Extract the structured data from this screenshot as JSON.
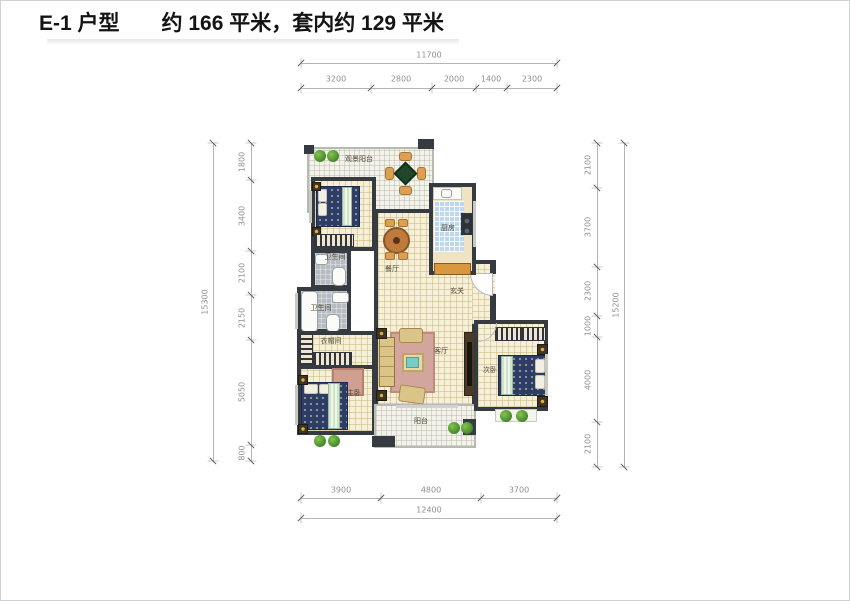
{
  "header": {
    "unit_name": "E-1 户型",
    "area_text": "约 166 平米，套内约 129 平米"
  },
  "rooms": {
    "view_balcony": "观景阳台",
    "kitchen": "厨房",
    "dining": "餐厅",
    "entry": "玄关",
    "living": "客厅",
    "bath_upper": "卫生间",
    "bath_lower": "卫生间",
    "cloakroom": "衣帽间",
    "master_bedroom": "主卧",
    "second_bedroom": "次卧",
    "balcony": "阳台"
  },
  "dimensions": {
    "top": {
      "total": "11700",
      "segments": [
        "3200",
        "2800",
        "2000",
        "1400",
        "2300"
      ]
    },
    "bottom": {
      "total": "12400",
      "segments": [
        "3900",
        "4800",
        "3700"
      ]
    },
    "left": {
      "total": "15300",
      "segments": [
        "1800",
        "3400",
        "2100",
        "2150",
        "5050",
        "800"
      ]
    },
    "right": {
      "total": "15200",
      "segments": [
        "2100",
        "3700",
        "2300",
        "1000",
        "4000",
        "2100"
      ]
    }
  },
  "colors": {
    "wall": "#363b42",
    "floor": "#f7f0d8",
    "kitchen_tile": "#bdd8ec",
    "bath_floor": "#b5bcc2",
    "dim_text": "#8f8f8f"
  }
}
